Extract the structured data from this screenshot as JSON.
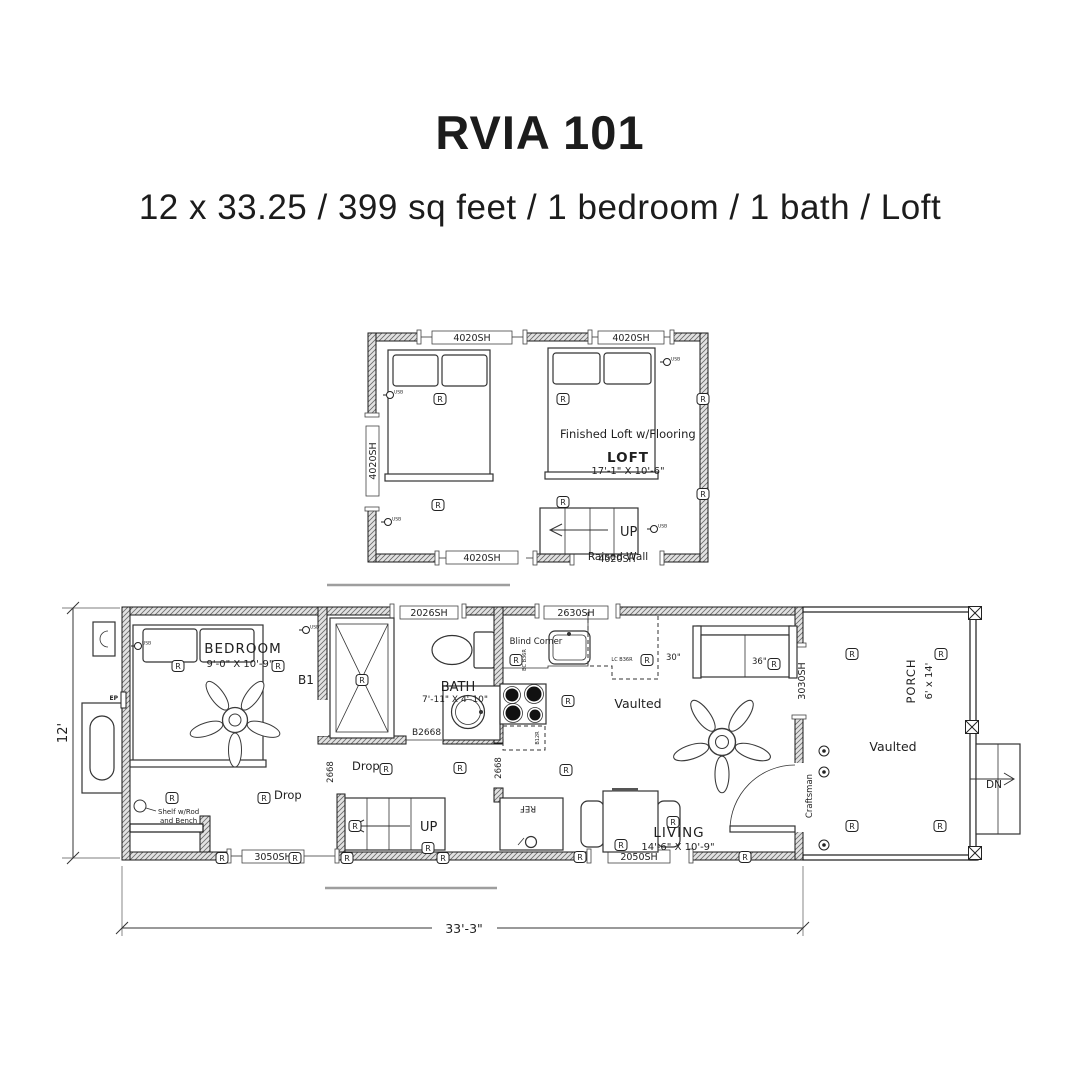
{
  "header": {
    "title": "RVIA 101",
    "subtitle": "12 x 33.25 / 399 sq feet / 1 bedroom / 1 bath / Loft"
  },
  "loft_plan": {
    "windows": {
      "top_left": "4020SH",
      "top_right": "4020SH",
      "left": "4020SH",
      "bottom_1": "4020SH",
      "bottom_2": "4020SH"
    },
    "note": "Finished Loft w/Flooring",
    "room": "LOFT",
    "dims": "17'-1\" X 10'-6\"",
    "stairs_up": "UP",
    "raised_wall": "Raised Wall"
  },
  "main_plan": {
    "windows": {
      "top_1": "2026SH",
      "top_2": "2630SH",
      "bottom_1": "3050SH",
      "bottom_2": "2050SH",
      "right": "3030SH"
    },
    "bedroom": {
      "room": "BEDROOM",
      "dims": "9'-0\" X 10'-9\"",
      "door_tag": "B1",
      "closet_line1": "Shelf w/Rod",
      "closet_line2": "and Bench",
      "panel": "EP"
    },
    "bath": {
      "room": "BATH",
      "dims": "7'-11\" X 4'-10\"",
      "door_tag": "B2668"
    },
    "hall": {
      "drop_1": "Drop",
      "drop_2": "Drop",
      "door_tag_1": "2668",
      "door_tag_2": "2668",
      "stairs_up": "UP"
    },
    "kitchen": {
      "blind_corner": "Blind Corner",
      "cab_1": "BC B36R",
      "cab_2": "LC B36R",
      "cab_3": "30\"",
      "cab_4": "B12R",
      "fridge": "REF",
      "vaulted": "Vaulted"
    },
    "living": {
      "room": "LIVING",
      "dims": "14'-6\" X 10'-9\"",
      "sofa": "36\"",
      "entry_door": "Craftsman"
    },
    "porch": {
      "room": "PORCH",
      "dims": "6' x 14'",
      "vaulted": "Vaulted",
      "steps_dn": "DN"
    }
  },
  "dimensions": {
    "width": "12'",
    "length": "33'-3\""
  },
  "symbols": {
    "receptacle": "R",
    "usb": "USB"
  },
  "colors": {
    "ink": "#1f1f1f",
    "wall_fill": "#e2e2e2",
    "hatch_line": "#6a6a6a",
    "separator": "#9e9e9e"
  }
}
